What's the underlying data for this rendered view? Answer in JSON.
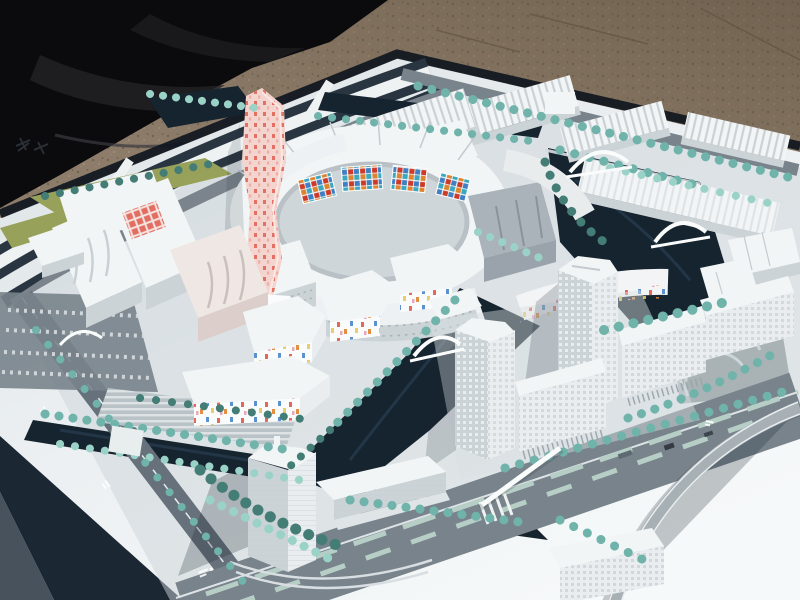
{
  "scene": {
    "description": "Outdoor photograph of a large white architectural scale model of a waterfront urban district, placed on a white presentation board over gravel pavement, with a black tarp folded at the upper left.",
    "environment": {
      "ground": "brown gravel pavement",
      "cover": "black tarp cloth, upper-left",
      "board": "white model base board with printed dark ring road"
    },
    "model": {
      "districts": [
        {
          "name": "spiral-tower",
          "desc": "tall tapered tower with pink facade covered in red dot pattern"
        },
        {
          "name": "ring-courtyard",
          "desc": "oval courtyard building with colored mosaic panels on the inner wall"
        },
        {
          "name": "industrial-rows",
          "desc": "long sawtooth-roof halls along the north edge"
        },
        {
          "name": "wavy-slabs",
          "desc": "large white slab blocks with wavy facade lines, west side"
        },
        {
          "name": "confetti-housing",
          "desc": "low white blocks speckled with multicolored window dots"
        },
        {
          "name": "twin-towers",
          "desc": "two tall white office towers with gridded facades beside the canal"
        },
        {
          "name": "south-tower",
          "desc": "translucent white high-rise with stepped podium, bottom center"
        },
        {
          "name": "canals",
          "desc": "dark navy water channels crossed by white arch bridges"
        },
        {
          "name": "boulevard",
          "desc": "wide grey avenue with planted medians and a curved flyover ramp, bottom right"
        },
        {
          "name": "tree-rows",
          "desc": "rows of teal model trees along streets and banks"
        }
      ]
    },
    "annotations": {
      "board_logo_marks": "two small dark printed marks on the board margin (illegible)",
      "street_label_marks": "tiny white street-name markings painted on roads (illegible)"
    }
  },
  "colors": {
    "gravel": "#8d7d6b",
    "gravelDark": "#6b5c4b",
    "gravelLight": "#a29078",
    "tarp": "#0b0b0d",
    "tarpFold": "#232327",
    "board": "#eef2f3",
    "boardFar": "#dde3e6",
    "boardShadow": "#1c2734",
    "edgeDark": "#0f1620",
    "water": "#16242f",
    "waterLight": "#2f4860",
    "road": "#78838b",
    "roadDark": "#66717b",
    "roadLight": "#98a2a7",
    "median": "#b7cec6",
    "ramp": "#a7b0b5",
    "bldg": "#f2f5f6",
    "bldgLight": "#e9edef",
    "bldgShade": "#ccd3d7",
    "bldgDark": "#aab3b9",
    "tree": "#6fb3aa",
    "treeLight": "#9bd2c7",
    "treeDark": "#447d75",
    "grass": "#97a159",
    "pink": "#f3d4ce",
    "pinkDot": "#e0584a",
    "mosaicRed": "#cd3a28",
    "mosaicBlue": "#3f7fc4",
    "mosaicCyan": "#3aa8c0",
    "mosaicOrange": "#e0832e",
    "mosaicYellow": "#e6c75e",
    "confettiPink": "#e29ab0",
    "white": "#fafcfc",
    "quay": "#d7dde0",
    "shadow": "#1d2935"
  }
}
